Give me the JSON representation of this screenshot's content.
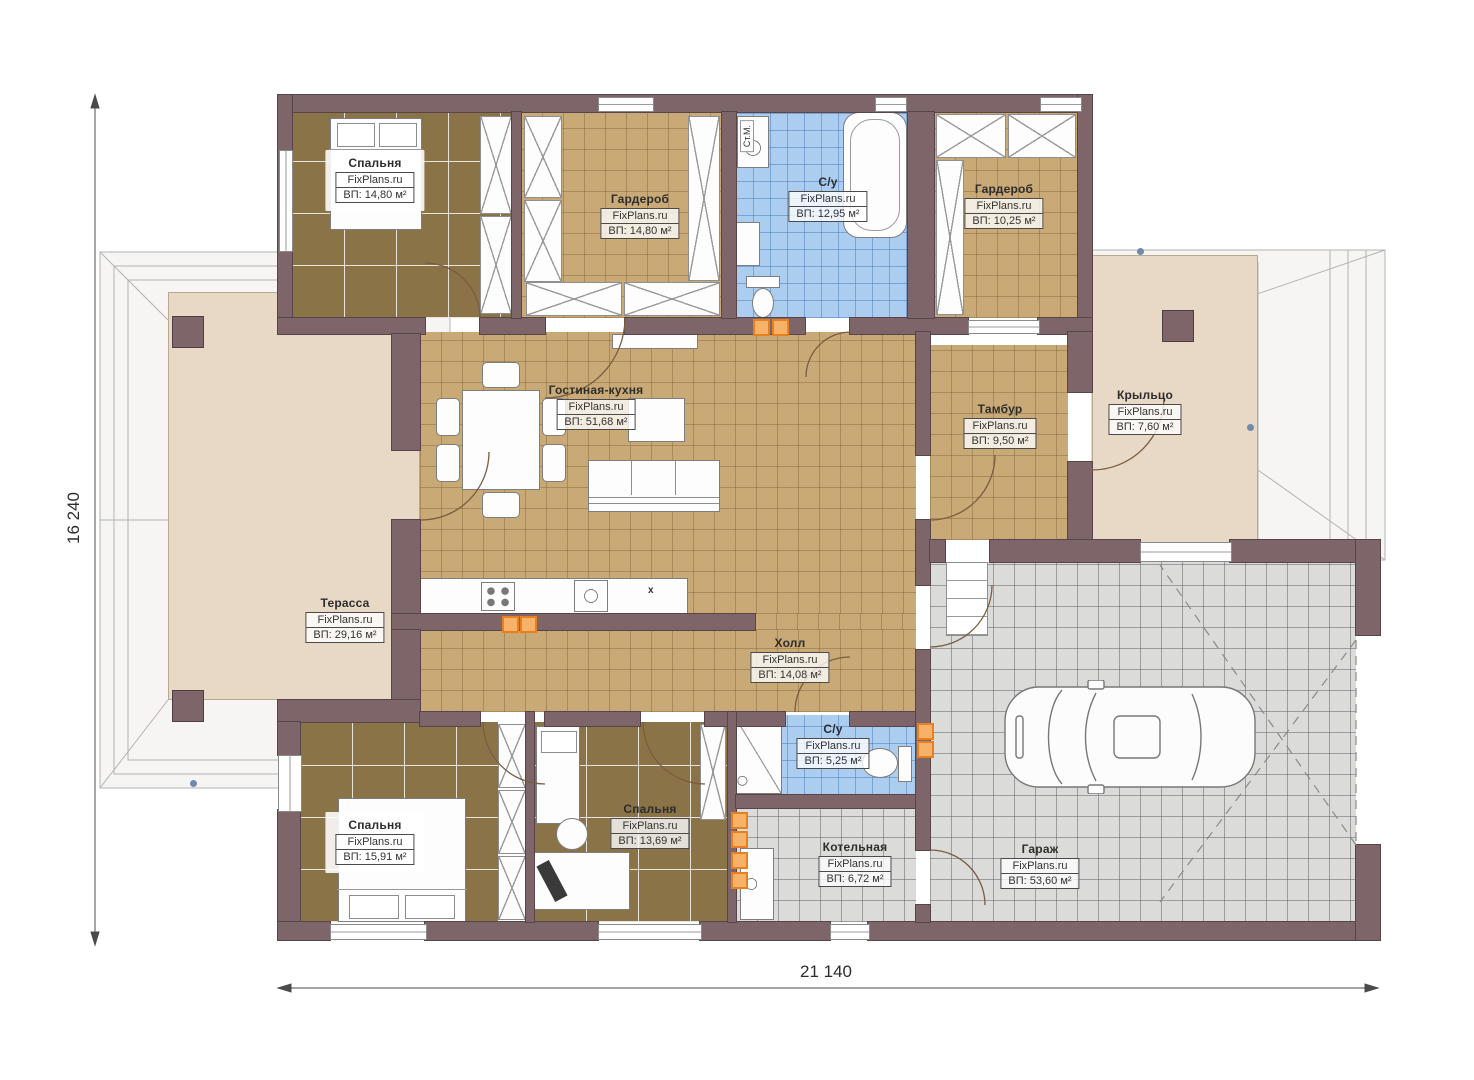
{
  "dimensions": {
    "horizontal": "21 140",
    "vertical": "16 240"
  },
  "brand": "FixPlans.ru",
  "rooms": {
    "bedroom1": {
      "name": "Спальня",
      "brand": "FixPlans.ru",
      "area": "ВП: 14,80 м²"
    },
    "wardrobe1": {
      "name": "Гардероб",
      "brand": "FixPlans.ru",
      "area": "ВП: 14,80 м²"
    },
    "bathroom1": {
      "name": "С/у",
      "brand": "FixPlans.ru",
      "area": "ВП: 12,95 м²"
    },
    "wardrobe2": {
      "name": "Гардероб",
      "brand": "FixPlans.ru",
      "area": "ВП: 10,25 м²"
    },
    "living": {
      "name": "Гостиная-кухня",
      "brand": "FixPlans.ru",
      "area": "ВП: 51,68 м²"
    },
    "tambour": {
      "name": "Тамбур",
      "brand": "FixPlans.ru",
      "area": "ВП: 9,50 м²"
    },
    "porch": {
      "name": "Крыльцо",
      "brand": "FixPlans.ru",
      "area": "ВП: 7,60 м²"
    },
    "terrace": {
      "name": "Терасса",
      "brand": "FixPlans.ru",
      "area": "ВП: 29,16 м²"
    },
    "hall": {
      "name": "Холл",
      "brand": "FixPlans.ru",
      "area": "ВП: 14,08 м²"
    },
    "bedroom2": {
      "name": "Спальня",
      "brand": "FixPlans.ru",
      "area": "ВП: 15,91 м²"
    },
    "bedroom3": {
      "name": "Спальня",
      "brand": "FixPlans.ru",
      "area": "ВП: 13,69 м²"
    },
    "bathroom2": {
      "name": "С/у",
      "brand": "FixPlans.ru",
      "area": "ВП: 5,25 м²"
    },
    "boiler": {
      "name": "Котельная",
      "brand": "FixPlans.ru",
      "area": "ВП: 6,72 м²"
    },
    "garage": {
      "name": "Гараж",
      "brand": "FixPlans.ru",
      "area": "ВП: 53,60 м²"
    }
  },
  "annotations": {
    "washing_machine": "Ст.М.",
    "counter_mark": "x"
  },
  "colors": {
    "wall": "#7d6569",
    "floor_wood": "#8b7348",
    "floor_tile_tan": "#c9aa76",
    "floor_tile_blue": "#abcdf0",
    "floor_tile_gray": "#dbdbda",
    "terrace_floor": "#e8d9c6",
    "vent_orange": "#e8801e"
  }
}
